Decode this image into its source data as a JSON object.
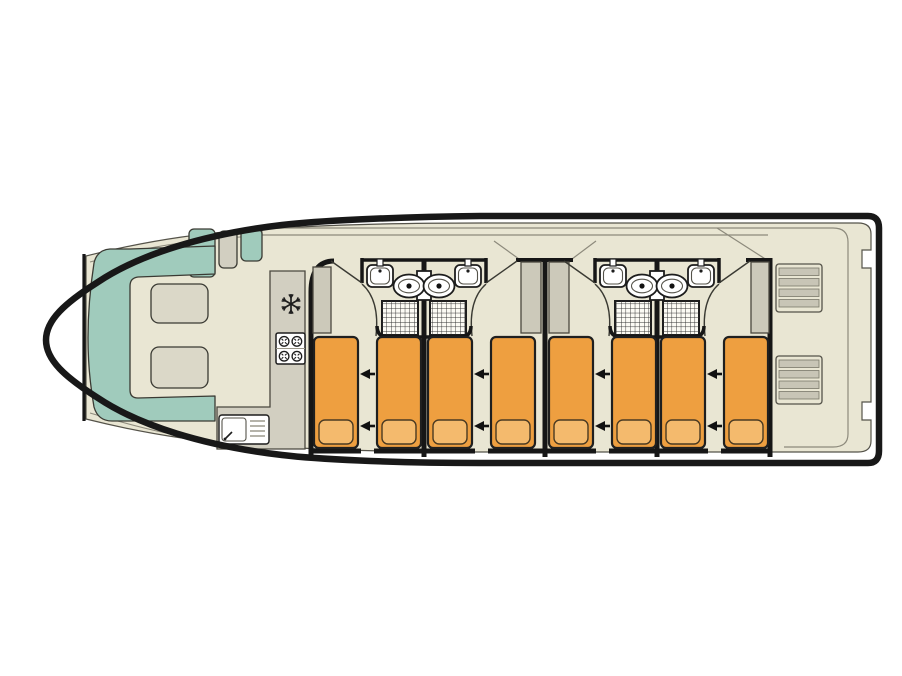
{
  "page": {
    "kind": "houseboat-deck-plan",
    "background": "#ffffff",
    "title": ""
  },
  "colors": {
    "hull": "#181818",
    "wall": "#161616",
    "deck": "#e9e6d3",
    "deck_line": "#8d8a7c",
    "thin_dark": "#3a3a33",
    "teal": "#a0cbbc",
    "teal_stroke": "#3a3a33",
    "furniture_gray": "#d2cfc1",
    "wardrobe_gray": "#ccc9ba",
    "tread_gray": "#c8c5b6",
    "table": "#dbd8c8",
    "bed": "#ee9f40",
    "bed_stroke": "#1f1f1f",
    "pillow": "#f4ba6d",
    "pillow_stroke": "#4a3a22",
    "fixture_fill": "#ffffff",
    "fixture_stroke": "#1d1d1d",
    "shower_fill": "#fcfbf4",
    "grid_stroke": "#2c2c2c",
    "arrow": "#111111"
  },
  "inventory": {
    "cabins": 4,
    "single_beds": 8,
    "bed_convert_arrows": 8,
    "bathrooms": 4,
    "washbasins": 4,
    "toilets": 4,
    "showers": 4,
    "wardrobes": 4,
    "saloon_tables": 2,
    "bow_seats": 2,
    "stove_burners": 4,
    "fridge": 1,
    "galley_sink": 1,
    "stern_staircases": 2
  },
  "layout": {
    "bed": {
      "y": 337,
      "w": 44,
      "h": 111,
      "rx": 5,
      "pillow": {
        "dx": 5,
        "dy": 83,
        "w": 34,
        "h": 24,
        "rx": 6
      }
    },
    "beds_x": [
      314,
      377,
      428,
      491,
      549,
      612,
      661,
      724
    ],
    "cabin_walls": [
      {
        "x": 311,
        "y1": 292,
        "y2": 457,
        "corner": true
      },
      {
        "x": 424,
        "y1": 260,
        "y2": 457,
        "corner": false
      },
      {
        "x": 545,
        "y1": 258,
        "y2": 457,
        "corner": false
      },
      {
        "x": 657,
        "y1": 260,
        "y2": 457,
        "corner": false
      },
      {
        "x": 770,
        "y1": 258,
        "y2": 457,
        "corner": false
      }
    ],
    "floor_segments": [
      [
        311,
        361
      ],
      [
        374,
        475
      ],
      [
        488,
        596
      ],
      [
        609,
        708
      ],
      [
        721,
        771
      ]
    ],
    "top_stubs": [
      [
        516,
        573
      ],
      [
        746,
        771
      ]
    ],
    "bathroom_pairs": [
      {
        "cx": 424
      },
      {
        "cx": 657
      }
    ],
    "wardrobes": [
      [
        313,
        267,
        18,
        66
      ],
      [
        521,
        262,
        20,
        71
      ],
      [
        549,
        262,
        20,
        71
      ],
      [
        751,
        262,
        18,
        71
      ]
    ],
    "stairs": [
      [
        776,
        264
      ],
      [
        776,
        356
      ]
    ],
    "stair": {
      "w": 46,
      "h": 48,
      "treads": 4
    },
    "tables": [
      [
        151,
        284,
        57,
        39
      ],
      [
        151,
        347,
        57,
        41
      ]
    ],
    "teal_tab": [
      189,
      229,
      26,
      48
    ],
    "bow_seats": [
      {
        "x": 219,
        "y": 231,
        "w": 18,
        "h": 37,
        "color": "gray"
      },
      {
        "x": 241,
        "y": 229,
        "w": 21,
        "h": 32,
        "color": "teal"
      }
    ],
    "arrows": {
      "gaps": [
        [
          360,
          375
        ],
        [
          474,
          489
        ],
        [
          595,
          610
        ],
        [
          707,
          722
        ]
      ],
      "ys": [
        374,
        426
      ]
    },
    "snowflake": {
      "cx": 291,
      "cy": 304,
      "r": 10
    },
    "stove": {
      "x": 276,
      "y": 333,
      "w": 29,
      "h": 31
    },
    "sink_unit": {
      "x": 219,
      "y": 415,
      "w": 50,
      "h": 29
    },
    "diagonals": [
      [
        494,
        241,
        519,
        259
      ],
      [
        596,
        241,
        572,
        259
      ],
      [
        717,
        228,
        770,
        262
      ]
    ]
  }
}
